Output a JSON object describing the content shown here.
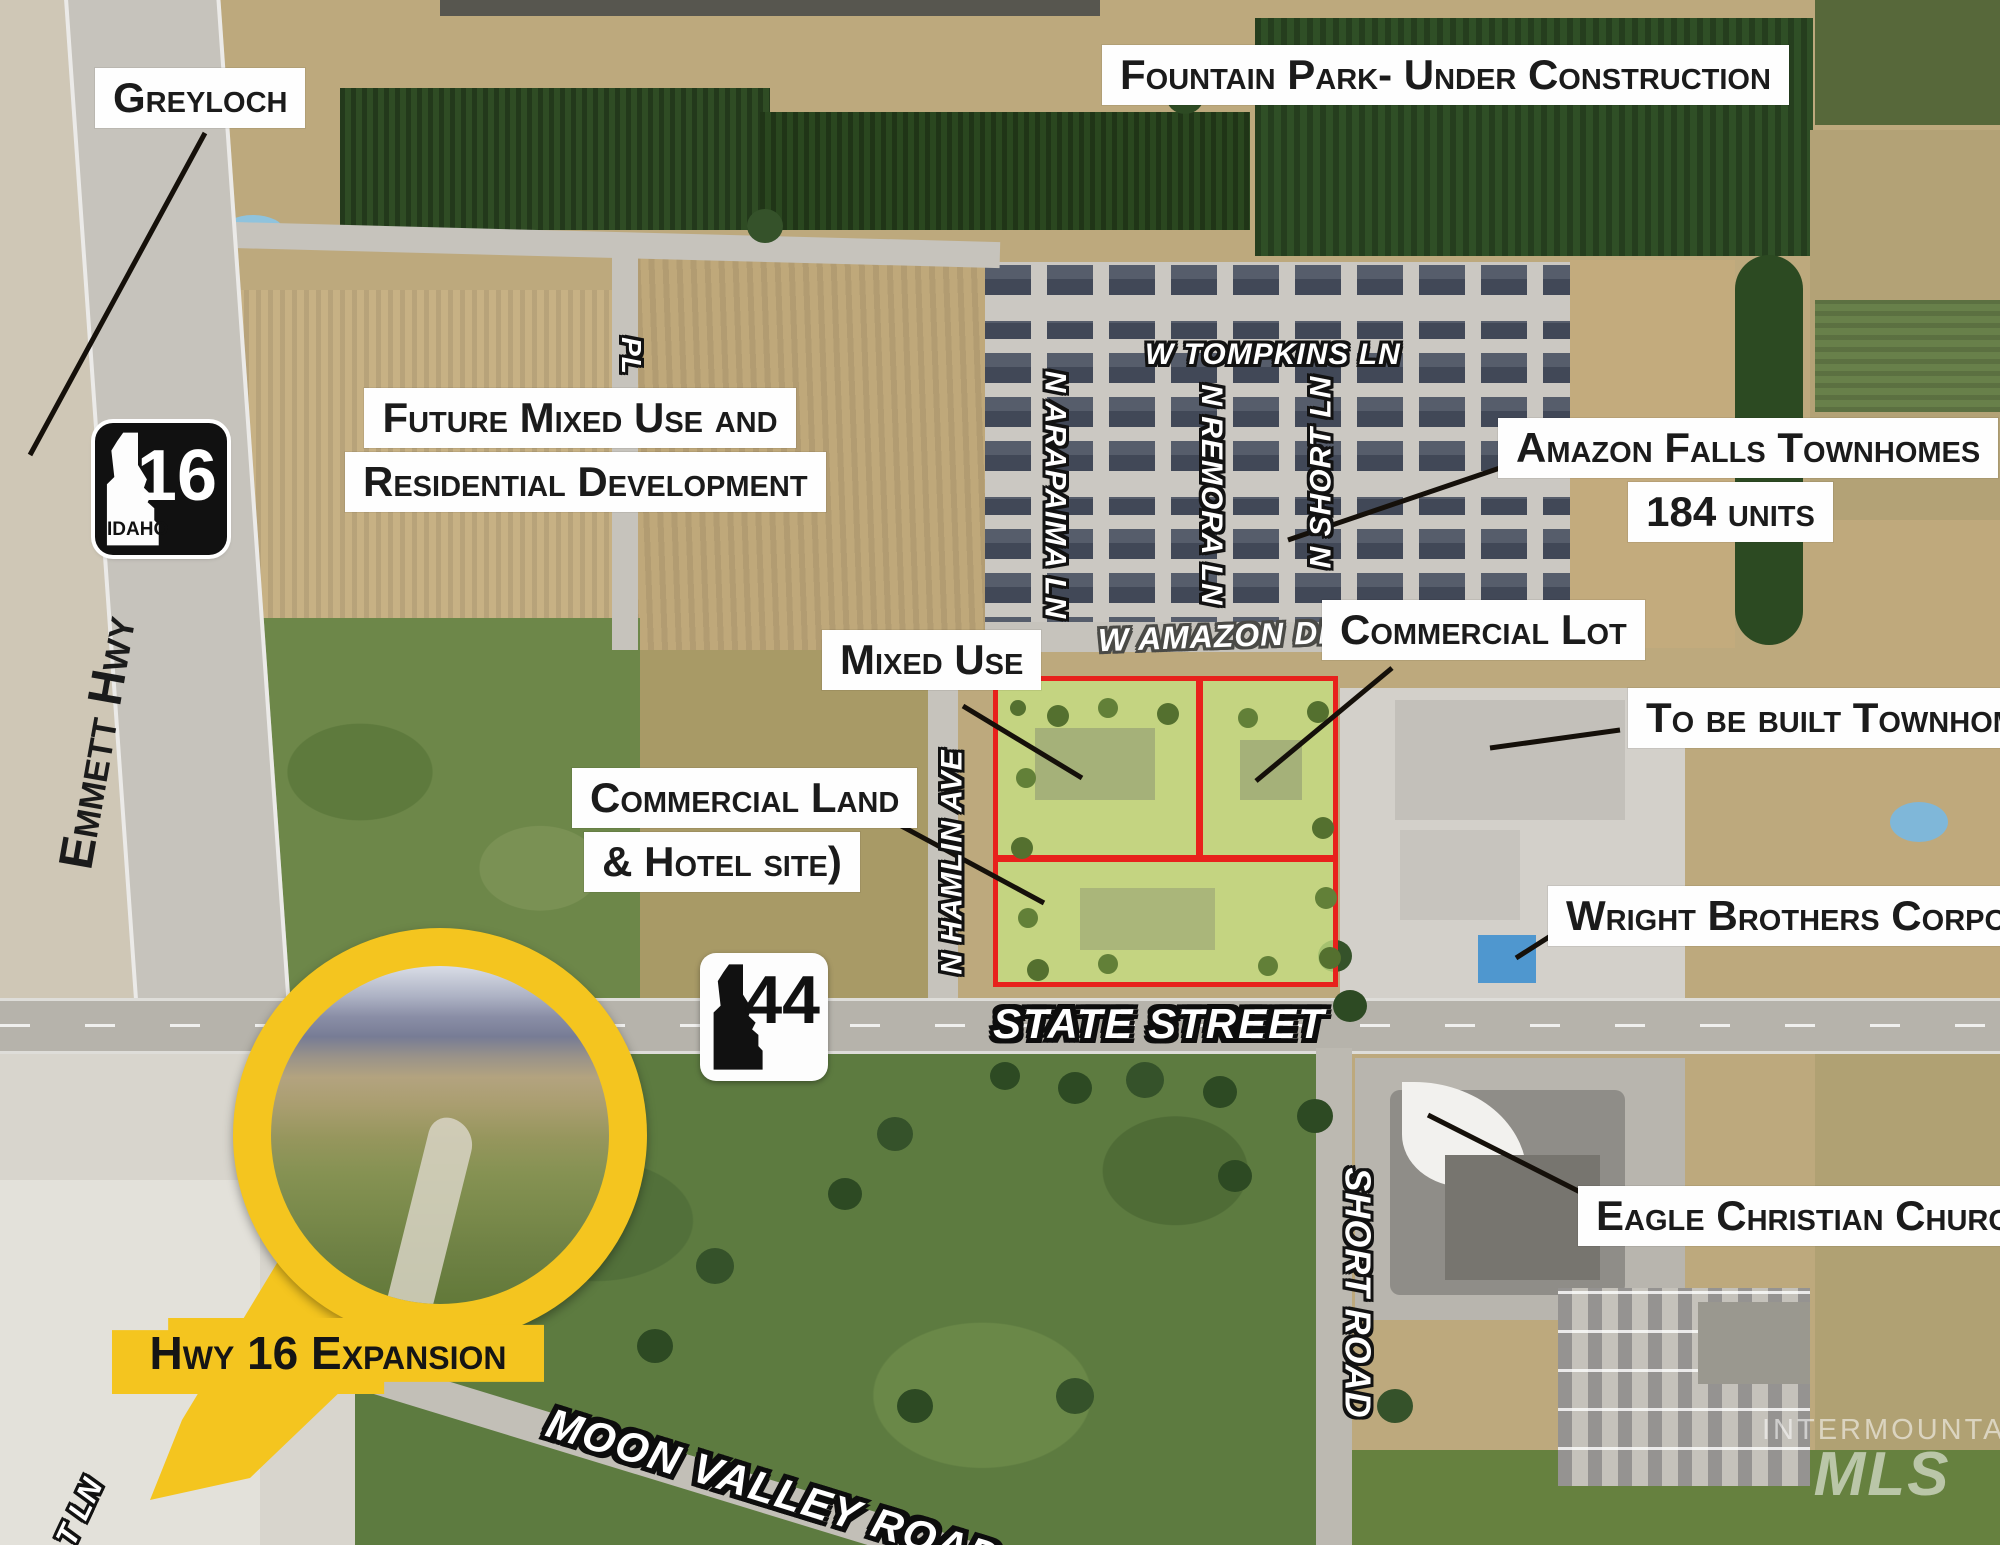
{
  "map": {
    "callouts": {
      "greyloch": "Greyloch",
      "fountain_park": "Fountain Park- Under Construction",
      "future_dev_line1": "Future Mixed Use and",
      "future_dev_line2": "Residential Development",
      "amazon_falls_line1": "Amazon Falls Townhomes",
      "amazon_falls_line2": "184 units",
      "mixed_use": "Mixed Use",
      "commercial_lot": "Commercial Lot",
      "to_be_built": "To be built Townhomes",
      "commercial_land_line1": "Commercial Land",
      "commercial_land_line2": "& Hotel site)",
      "wright_brothers": "Wright Brothers Corporate",
      "eagle_church": "Eagle Christian Church",
      "hwy16_expansion": "Hwy 16 Expansion"
    },
    "streets": {
      "tompkins": "W TOMPKINS LN",
      "arapaima": "N ARAPAIMA LN",
      "remora": "N REMORA LN",
      "short_ln": "N SHORT LN",
      "amazon_dr": "W AMAZON DR",
      "hamlin": "N HAMLIN AVE",
      "state_street": "STATE STREET",
      "short_road": "SHORT ROAD",
      "moon_valley": "MOON VALLEY ROAD",
      "emmett_hwy": "Emmett Hwy",
      "pl_partial": "PL",
      "t_ln_partial": "T LN"
    },
    "shields": {
      "hwy16": {
        "number": "16",
        "state_label": "IDAHO"
      },
      "hwy44": {
        "number": "44"
      }
    },
    "watermark": {
      "line1": "INTERMOUNTAIN",
      "line2": "MLS"
    },
    "colors": {
      "callout_bg": "#fefefe",
      "callout_text": "#1b1b1b",
      "parcel_outline_red": "#e8211c",
      "parcel_fill_green": "#c5e083",
      "pin_yellow": "#f4c51f",
      "street_text_white": "#ffffff",
      "street_outline_black": "#121212",
      "leader_line": "#15100a"
    }
  }
}
